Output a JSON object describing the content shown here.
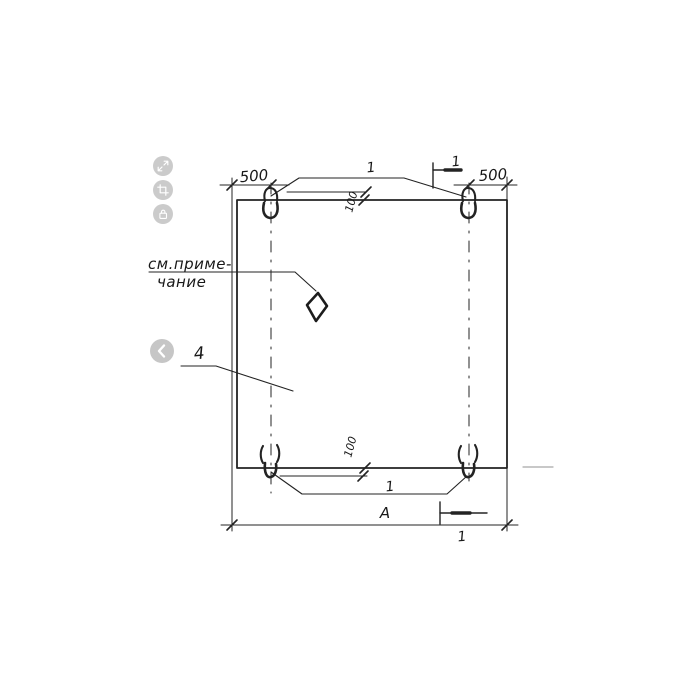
{
  "viewer": {
    "background_color": "#ffffff",
    "toolbar": {
      "buttons": [
        {
          "name": "expand",
          "icon": "expand-icon"
        },
        {
          "name": "crop",
          "icon": "crop-icon"
        },
        {
          "name": "protected",
          "icon": "lock-icon"
        }
      ]
    },
    "carousel": {
      "prev_icon": "chevron-left-icon"
    }
  },
  "drawing": {
    "line_color": "#222222",
    "icon_button_color": "#cbcbcb",
    "labels": {
      "dim_top_left": "500",
      "dim_top_right": "500",
      "dim_offset_top": "100",
      "dim_offset_bottom": "100",
      "loop_callout_top": "1",
      "loop_callout_bottom": "1",
      "section_mark_top": "1",
      "section_mark_bottom": "1",
      "panel_callout": "4",
      "note_line1": "см.приме-",
      "note_line2": "чание",
      "overall_width": "А"
    }
  }
}
